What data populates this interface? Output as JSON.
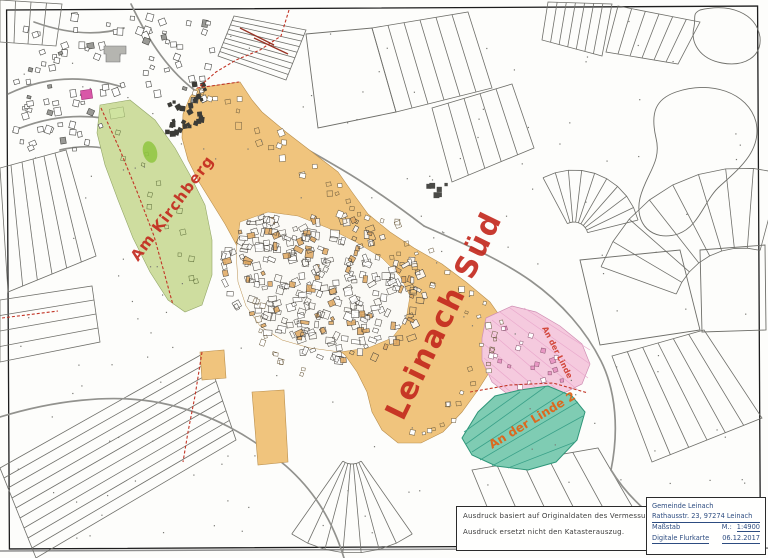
{
  "map": {
    "boundary_color": "#c23526",
    "zone_colors": {
      "development": "#f0c47d",
      "green": "#cedd9f",
      "pink": "#f5cade",
      "teal": "#7fccb3",
      "highlight_building": "#d957a8"
    },
    "labels": {
      "main": {
        "text": "Leinach Süd",
        "color": "#c3271c"
      },
      "kirchberg": {
        "text": "Am Kirchberg",
        "color": "#c3271c"
      },
      "linde": {
        "text": "An der Linde",
        "color": "#cf3a2b"
      },
      "linde2": {
        "text": "An der Linde 2",
        "color": "#e06418"
      }
    }
  },
  "disclaimer": {
    "line1": "Ausdruck basiert auf Originaldaten des Vermessungsamtes.",
    "line2": "Ausdruck ersetzt nicht den Katasterauszug."
  },
  "info_box": {
    "municipality": "Gemeinde Leinach",
    "address": "Rathausstr. 23, 97274 Leinach",
    "scale_label": "Maßstab",
    "scale_prefix": "M.:",
    "scale_value": "1:4900",
    "map_type": "Digitale Flurkarte",
    "date": "06.12.2017"
  }
}
